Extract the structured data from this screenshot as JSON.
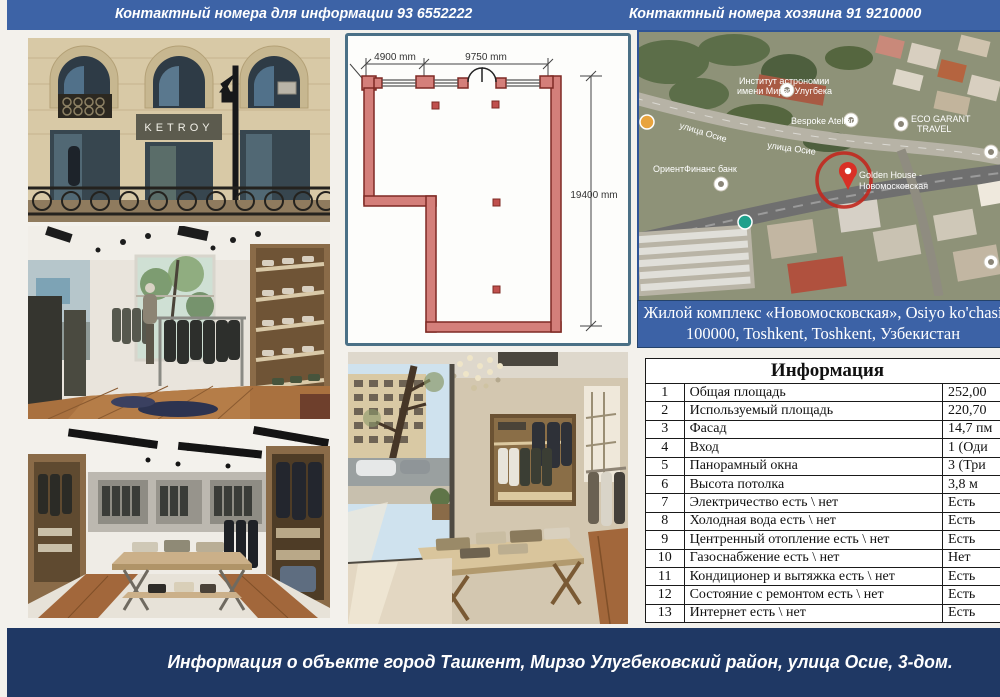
{
  "header": {
    "contact_info": "Контактный номера для информации 93 6552222",
    "contact_owner": "Контактный номера хозяина 91 9210000"
  },
  "photos": {
    "facade_sign": "KETROY"
  },
  "floor_plan": {
    "dim_left": "4900 mm",
    "dim_top": "9750 mm",
    "dim_side": "19400 mm"
  },
  "map": {
    "label_institute_line1": "Институт астрономии",
    "label_institute_line2": "имени Мирзо Улугбека",
    "label_street_1": "улица Осие",
    "label_street_2": "улица Осие",
    "label_bespoke": "Bespoke Atelier",
    "label_eco_line1": "ECO GARANT",
    "label_eco_line2": "TRAVEL",
    "label_bank": "ОриентФинанс банк",
    "label_pin_line1": "Golden House -",
    "label_pin_line2": "Новомосковская",
    "caption_line1": "Жилой комплекс «Новомосковская», Osiyo ko'chasi",
    "caption_line2": "100000, Toshkent, Toshkent, Узбекистан"
  },
  "table": {
    "title": "Информация",
    "rows": [
      {
        "num": "1",
        "name": "Общая площадь",
        "value": "252,00"
      },
      {
        "num": "2",
        "name": "Используемый площадь",
        "value": "220,70"
      },
      {
        "num": "3",
        "name": "Фасад",
        "value": "14,7 пм"
      },
      {
        "num": "4",
        "name": "Вход",
        "value": "1 (Оди"
      },
      {
        "num": "5",
        "name": "Панорамный окна",
        "value": "3 (Три"
      },
      {
        "num": "6",
        "name": "Высота потолка",
        "value": "3,8 м"
      },
      {
        "num": "7",
        "name": "Электричество  есть \\ нет",
        "value": "Есть"
      },
      {
        "num": "8",
        "name": "Холодная вода  есть \\ нет",
        "value": "Есть"
      },
      {
        "num": "9",
        "name": "Центренный отопление  есть \\ нет",
        "value": "Есть"
      },
      {
        "num": "10",
        "name": "Газоснабжение  есть \\ нет",
        "value": "Нет"
      },
      {
        "num": "11",
        "name": "Кондиционер и вытяжка  есть \\ нет",
        "value": "Есть"
      },
      {
        "num": "12",
        "name": "Состояние с ремонтом  есть \\ нет",
        "value": "Есть"
      },
      {
        "num": "13",
        "name": "Интернет  есть \\ нет",
        "value": "Есть"
      }
    ]
  },
  "footer": {
    "text": "Информация о объекте город Ташкент, Мирзо Улугбековский район, улица Осие, 3-дом."
  },
  "colors": {
    "header_blue": "#3d63a6",
    "caption_blue": "#3c62a6",
    "footer_navy": "#1f3864",
    "plan_wall": "#d47f7a",
    "map_pin_red": "#d93025"
  }
}
